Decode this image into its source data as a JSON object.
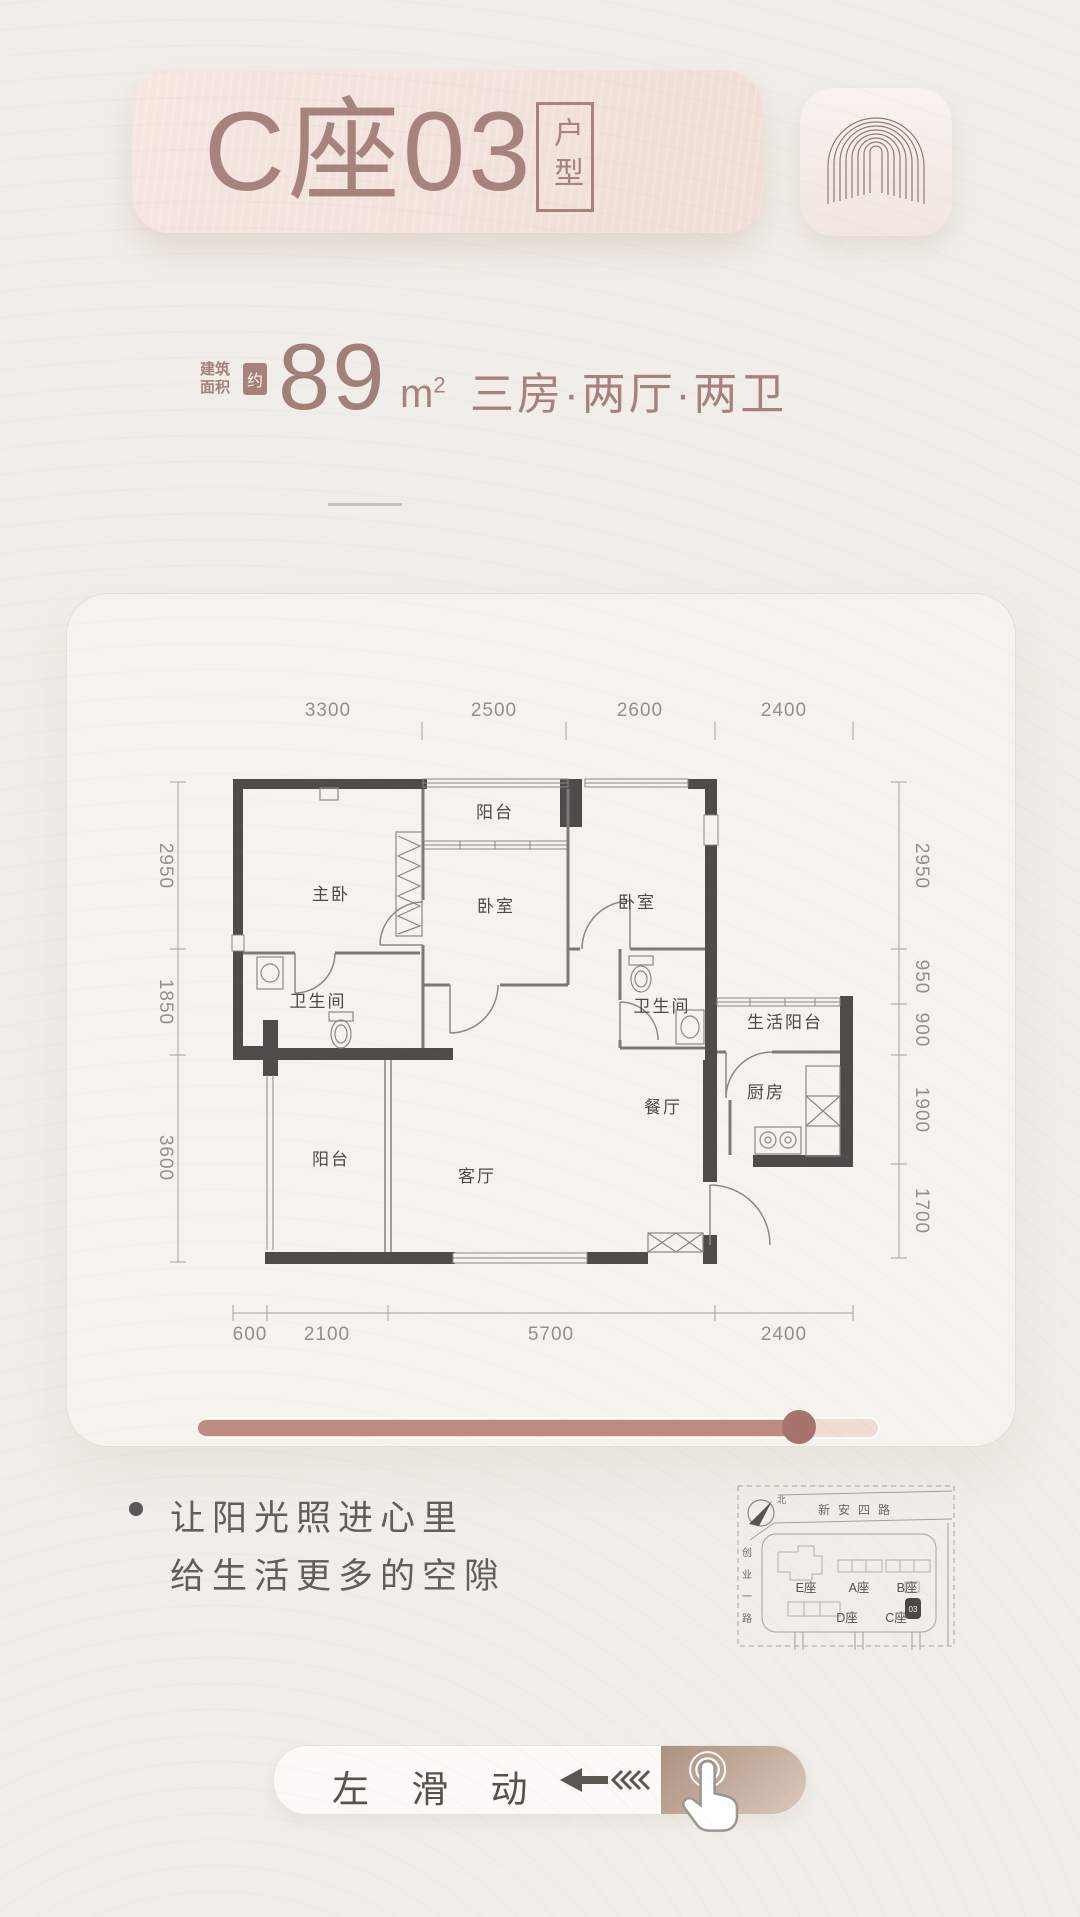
{
  "header": {
    "title": "C座03",
    "badge": "户型"
  },
  "area": {
    "prefix_line1": "建筑",
    "prefix_line2": "面积",
    "approx_badge": "约",
    "value": "89",
    "unit": "m",
    "unit_sup": "2",
    "rooms": "三房·两厅·两卫"
  },
  "floorplan": {
    "dims_top": [
      "3300",
      "2500",
      "2600",
      "2400"
    ],
    "dims_bottom": [
      "600",
      "2100",
      "5700",
      "2400"
    ],
    "dims_left": [
      "2950",
      "1850",
      "3600"
    ],
    "dims_right": [
      "2950",
      "950",
      "900",
      "1900",
      "1700"
    ],
    "rooms": {
      "master_bedroom": "主卧",
      "top_balcony": "阳台",
      "bedroom_2": "卧室",
      "bedroom_3": "卧室",
      "bathroom_1": "卫生间",
      "bathroom_2": "卫生间",
      "living_balcony": "生活阳台",
      "kitchen": "厨房",
      "dining_room": "餐厅",
      "living_room": "客厅",
      "bottom_balcony": "阳台"
    }
  },
  "slider": {
    "progress_percent": 88
  },
  "tagline": {
    "line1": "让阳光照进心里",
    "line2": "给生活更多的空隙"
  },
  "site_map": {
    "north_label": "北",
    "road_top": "新安四路",
    "road_left": "创业一路",
    "road_left_chars": [
      "创",
      "业",
      "一",
      "路"
    ],
    "buildings": [
      {
        "label": "E座"
      },
      {
        "label": "A座"
      },
      {
        "label": "B座"
      },
      {
        "label": "D座"
      },
      {
        "label": "C座"
      }
    ],
    "current_marker": "03"
  },
  "swipe_hint": {
    "label": "左 滑 动"
  },
  "colors": {
    "accent": "#a7827c",
    "wall": "#4e4b48",
    "slider_fill": "#bc8b84",
    "slider_knob": "#a6746c",
    "page_bg": "#f1eee9",
    "header_bg": "#f3e2dd"
  }
}
